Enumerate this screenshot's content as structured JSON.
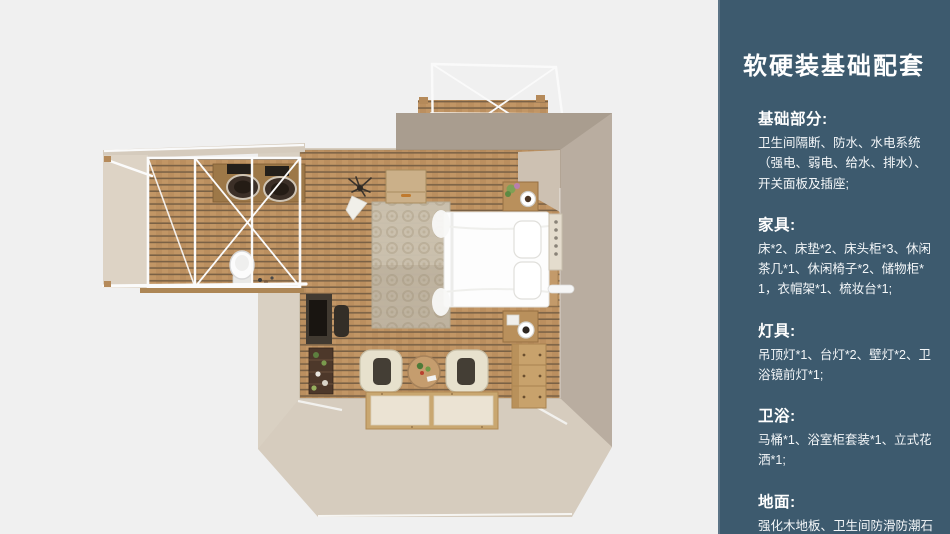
{
  "page": {
    "background": "#f0f0f0",
    "description": "top-down 3D floor plan render of a guest room with bathroom wing and balcony"
  },
  "sidebar": {
    "background": "#3d5a6e",
    "border_accent": "#5c7486",
    "text_color": "#ffffff",
    "title": "软硬装基础配套",
    "sections": [
      {
        "heading": "基础部分:",
        "body": "卫生间隔断、防水、水电系统（强电、弱电、给水、排水）、开关面板及插座;"
      },
      {
        "heading": "家具:",
        "body": "床*2、床垫*2、床头柜*3、休闲茶几*1、休闲椅子*2、储物柜*1，衣帽架*1、梳妆台*1;"
      },
      {
        "heading": "灯具:",
        "body": "吊顶灯*1、台灯*2、壁灯*2、卫浴镜前灯*1;"
      },
      {
        "heading": "卫浴:",
        "body": "马桶*1、浴室柜套装*1、立式花洒*1;"
      },
      {
        "heading": "地面:",
        "body": "强化木地板、卫生间防滑防潮石塑板;"
      }
    ]
  },
  "floorplan": {
    "palette": {
      "wall_beige": "#d6ccbe",
      "wall_inner_light": "#d9d0c2",
      "wall_shadow": "#b9ada0",
      "wall_band_gray": "#a99d8f",
      "floor_wood": "#c29665",
      "floor_gap": "#5c4a38",
      "frame_white": "#fafafa",
      "furniture_wood": "#c8a26c",
      "counter_wood": "#9d7848",
      "bed_white": "#fdfdfd",
      "dark_furniture": "#413a31",
      "rug": "#cbc2b0",
      "chair_cream": "#e7e1cd"
    }
  }
}
